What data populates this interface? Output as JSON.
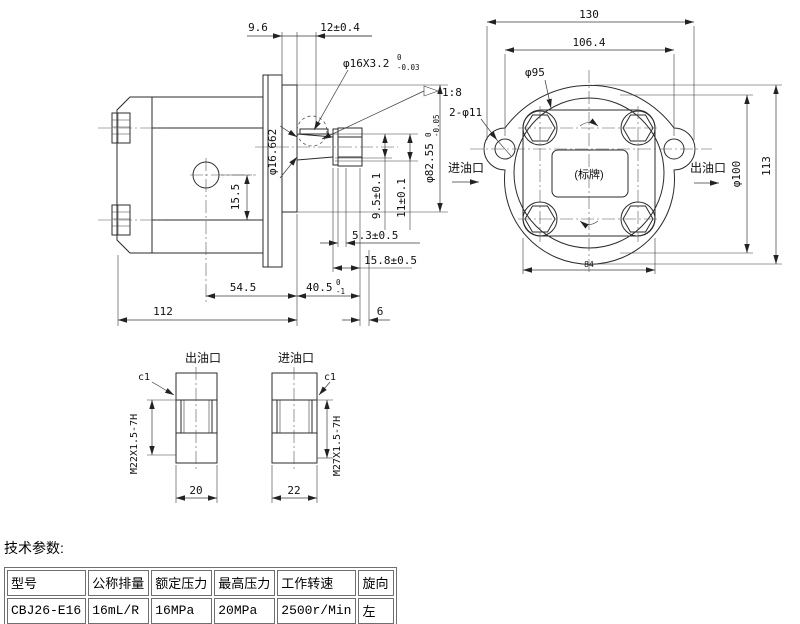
{
  "drawing": {
    "side": {
      "d_96": "9.6",
      "d_12": "12±0.4",
      "thread": "φ16X3.2",
      "thread_tu": "0",
      "thread_tl": "-0.03",
      "taper": "1:8",
      "d_16662": "φ16.662",
      "d_155": "15.5",
      "d_95k": "9.5±0.1",
      "d_11k": "11±0.1",
      "d_8255": "φ82.55",
      "d_8255_tu": "0",
      "d_8255_tl": "-0.05",
      "d_53": "5.3±0.5",
      "d_158": "15.8±0.5",
      "d_545": "54.5",
      "d_405": "40.5",
      "d_405_tu": "0",
      "d_405_tl": "-1",
      "d_112": "112",
      "d_6": "6"
    },
    "front": {
      "d_130": "130",
      "d_1064": "106.4",
      "d_95": "φ95",
      "d_2x11": "2-φ11",
      "inlet": "进油口",
      "outlet": "出油口",
      "plate": "(标牌)",
      "d_100": "φ100",
      "d_113": "113",
      "d_84": "84"
    },
    "sections": {
      "out_label": "出油口",
      "in_label": "进油口",
      "c1a": "c1",
      "c1b": "c1",
      "m22": "M22X1.5-7H",
      "m27": "M27X1.5-7H",
      "d_20": "20",
      "d_22": "22"
    }
  },
  "specs": {
    "title": "技术参数:",
    "headers": [
      "型号",
      "公称排量",
      "额定压力",
      "最高压力",
      "工作转速",
      "旋向"
    ],
    "values": [
      "CBJ26-E16",
      "16mL/R",
      "16MPa",
      "20MPa",
      "2500r/Min",
      "左"
    ]
  }
}
